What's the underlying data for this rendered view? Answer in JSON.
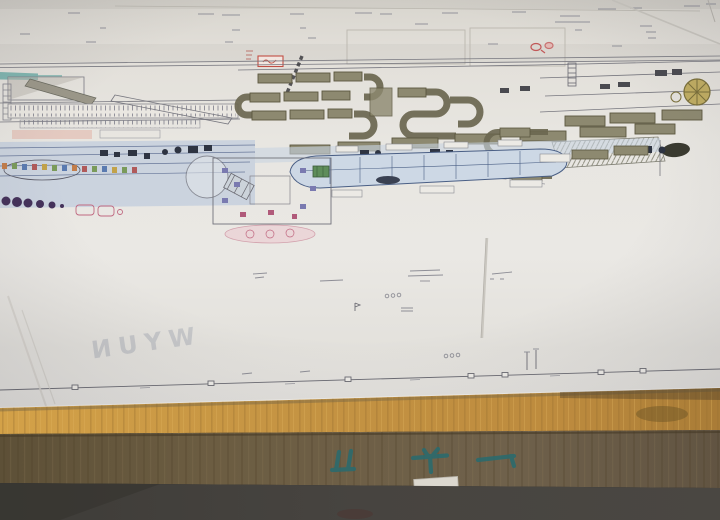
{
  "scene": {
    "subject": "photograph of a large factory layout engineering drawing lying on a wooden crate",
    "paper_orientation": "slightly tilted, bottom edge slanting up to the right"
  },
  "paper": {
    "bleed_text_mirrored": "WYUN",
    "stamp": "small red rectangular approval stamp",
    "legible_text": "none (all annotations below legibility at photo resolution)"
  },
  "crate": {
    "markings_style": "three green stenciled characters painted upside-down on crate side",
    "markings_count": 3,
    "sticker": "small pale label on crate edge"
  },
  "colors": {
    "paper": "#e6e4df",
    "line": "#5c5c64",
    "equipment_olive": "#8d8970",
    "equipment_olive_dark": "#5b573f",
    "process_blue": "#c3cedd",
    "hull_blue": "#cdd8e5",
    "teal_patch": "#74b0aa",
    "stamp_red": "#c0473c",
    "flywheel_yellow": "#c0ad62",
    "dot_purple": "#45325a",
    "accent_pink": "#cf8fa0",
    "crate_tan": "#c59443",
    "crate_brown": "#6c5d42",
    "floor_dark": "#454240",
    "crate_marking": "#2a6b6e",
    "bleed_text": "#9aa0ac"
  }
}
